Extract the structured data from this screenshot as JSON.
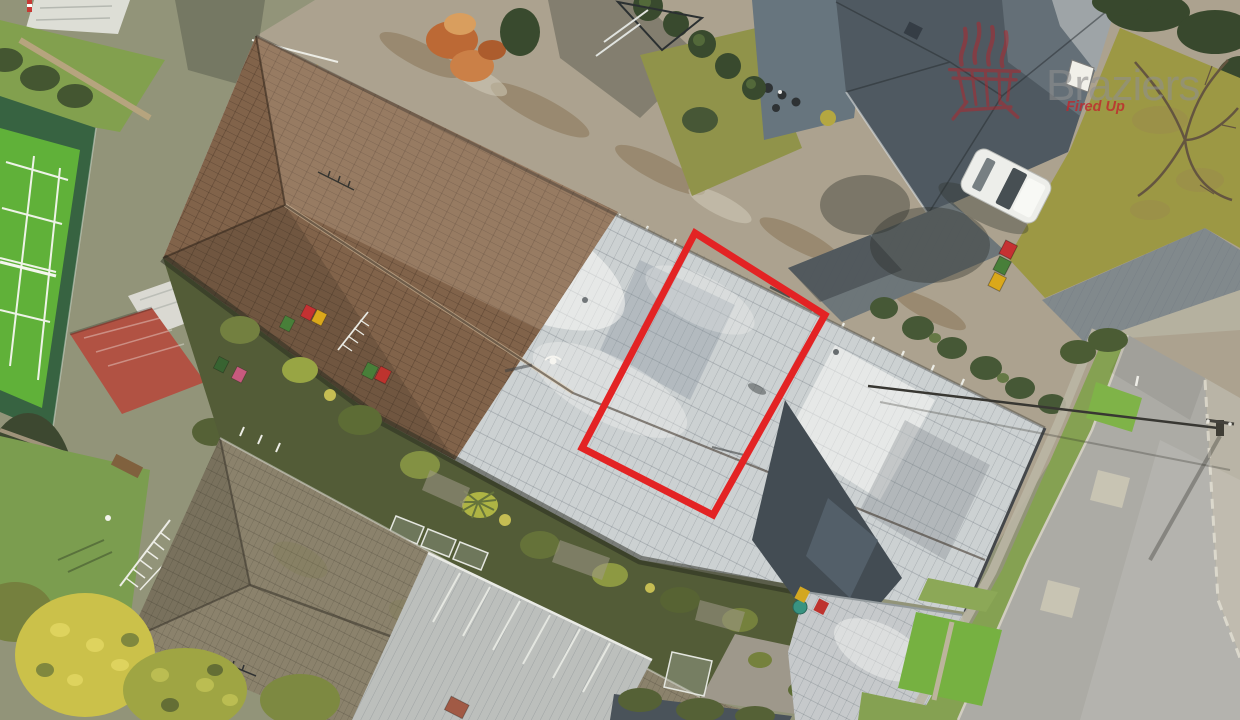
{
  "scene": {
    "type": "aerial-photograph",
    "palette": {
      "roof_brown": "#7b5c45",
      "roof_white": "#cad0d4",
      "roof_weathered": "#857d69",
      "roof_slate": "#46525d",
      "roof_navy": "#39444f",
      "shed_red": "#ad4a3e",
      "court_green": "#58ae33",
      "court_surround": "#2d5c3c",
      "driveway_concrete": "#a89f8e",
      "road_asphalt": "#a8a8a5",
      "garden_dark": "#4a5531",
      "grass_berm": "#7f9e4d",
      "lawn_olive": "#97943f"
    }
  },
  "annotation": {
    "boundary_color": "#e2191d"
  },
  "watermark": {
    "brand": "Braziers",
    "tagline": "Fired Up",
    "brand_color": "#8f8f8f",
    "tagline_color": "#c0272d",
    "logo_color": "#b5242b",
    "logo_icon": "brazier-fire-icon"
  }
}
